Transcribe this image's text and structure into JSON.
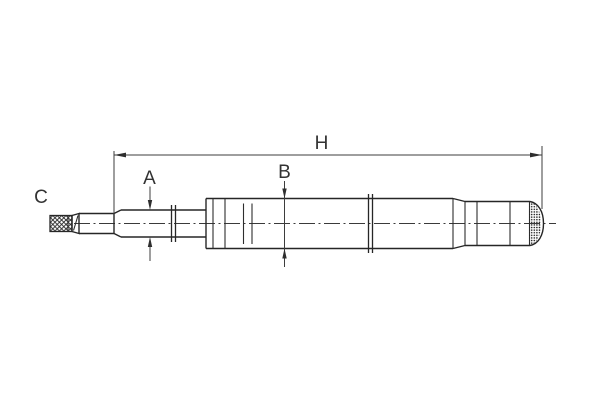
{
  "diagram": {
    "labels": {
      "overall_length": "H",
      "rod_diameter": "A",
      "body_diameter": "B",
      "thread_end": "C"
    },
    "colors": {
      "background": "#ffffff",
      "part_outline": "#262626",
      "dimension_lines": "#3d3d3d",
      "text": "#333333"
    }
  }
}
